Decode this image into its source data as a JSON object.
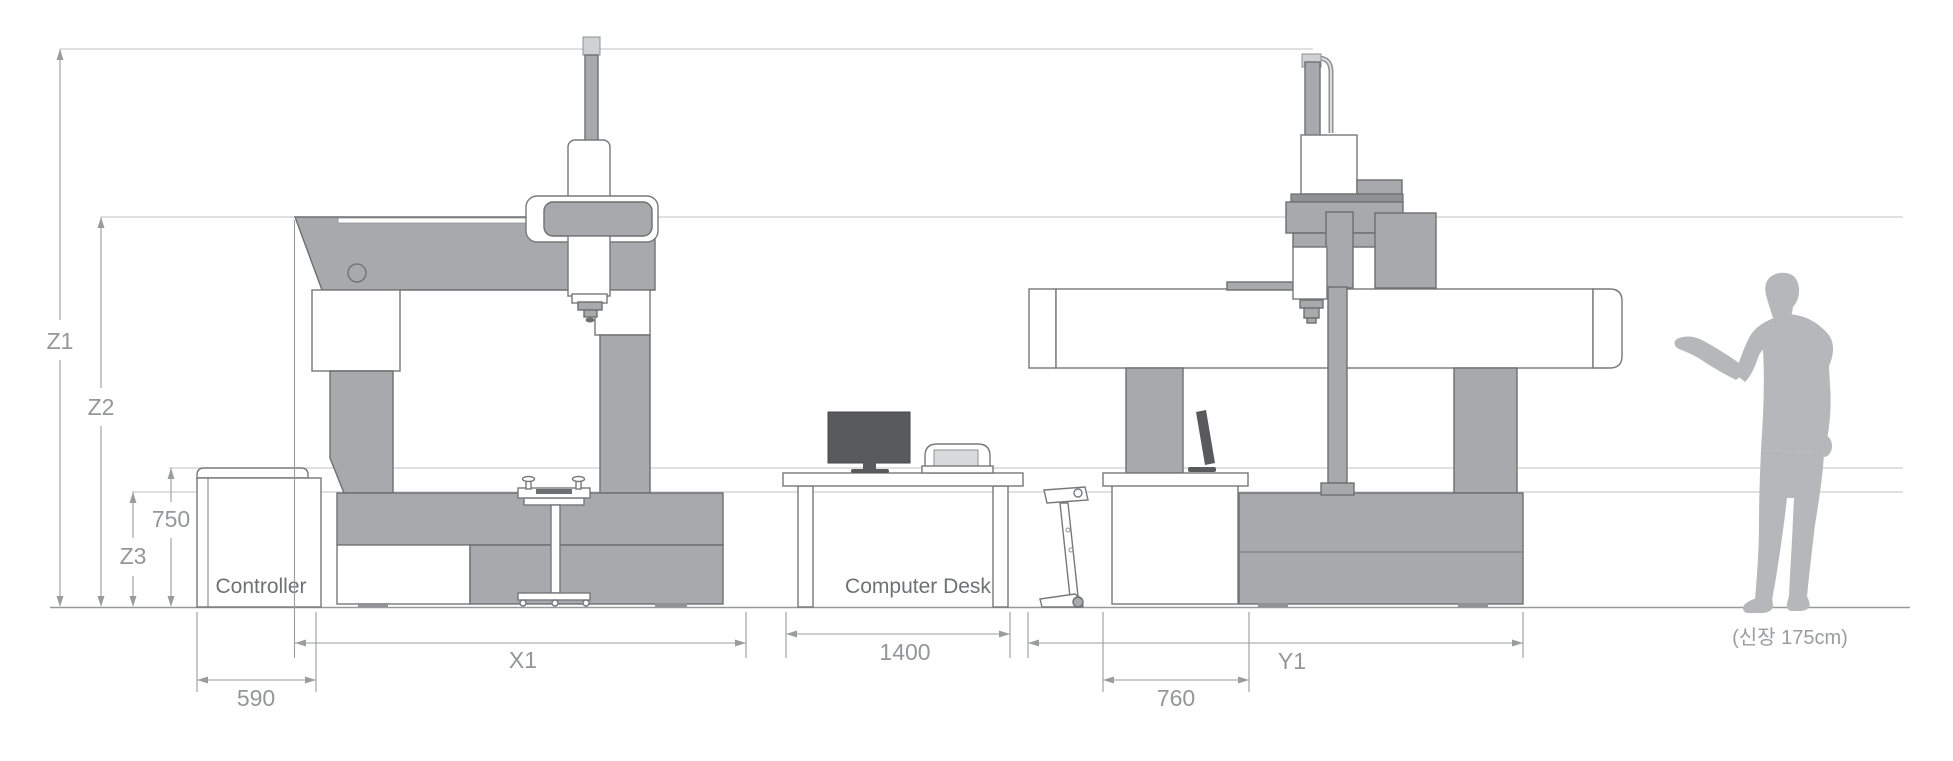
{
  "diagram": {
    "type": "cmm-installation-drawing",
    "views": [
      "front-view-machine",
      "computer-desk",
      "side-view-machine",
      "operator-silhouette"
    ]
  },
  "labels": {
    "controller": "Controller",
    "computer_desk": "Computer Desk",
    "person_height_note": "(신장 175cm)"
  },
  "dimensions": {
    "z1": "Z1",
    "z2": "Z2",
    "z3": "Z3",
    "controller_height": "750",
    "controller_width": "590",
    "x_axis": "X1",
    "desk_width": "1400",
    "console_width": "760",
    "y_axis": "Y1"
  },
  "colors": {
    "machine_gray": "#a7a9ac",
    "machine_outline": "#6d6f71",
    "white_part": "#ffffff",
    "monitor_dark": "#595a5c",
    "printer_panel": "#d9dadb",
    "reference_line": "#c0c2c5",
    "ground_line": "#97999c",
    "dimension_line": "#9a9c9f",
    "dimension_text": "#94969a",
    "object_label_text": "#6f7173",
    "person_silhouette": "#b5b7ba"
  }
}
